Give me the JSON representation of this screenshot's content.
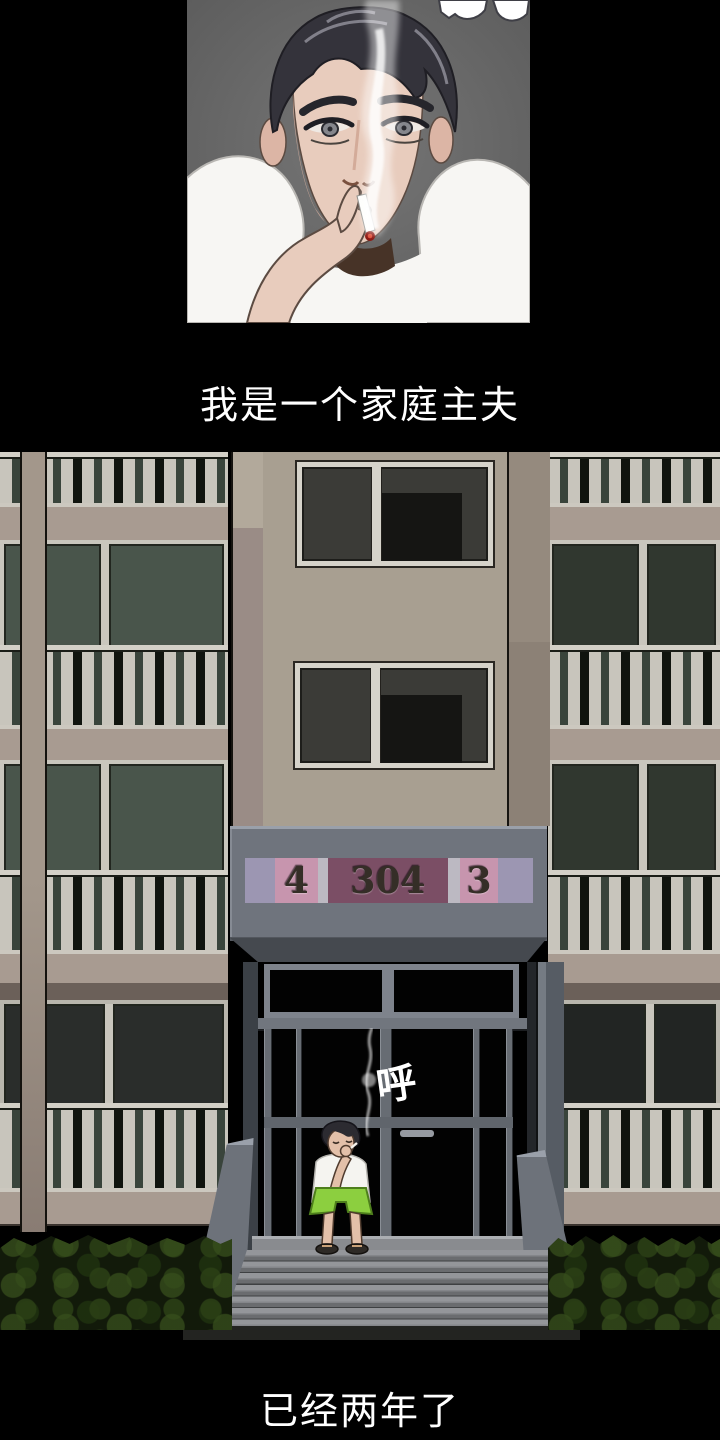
{
  "captions": {
    "narration_top": "我是一个家庭主夫",
    "narration_bottom": "已经两年了"
  },
  "building_sign": {
    "segment_left": "4",
    "segment_center": "304",
    "segment_right": "3"
  },
  "sfx": {
    "exhale": "呼"
  },
  "colors": {
    "page_bg": "#000000",
    "caption_text": "#ffffff",
    "portrait_panel_bg": "#6b6b6b",
    "wall_beige": "#a89f91",
    "canopy_gray": "#6f747d",
    "sign_lavender": "#9c96b2",
    "sign_pink": "#c795ae",
    "sign_mauve": "#7b4e65",
    "sign_gray": "#bcb9c2",
    "sign_digit": "#352e27",
    "railing_light": "#c8c5bc",
    "glass_green": "#49554b",
    "glass_dark": "#30372f",
    "bush_green": "#121a0a",
    "shorts_green": "#8ccf3f",
    "ember_red": "#8e1a14"
  }
}
